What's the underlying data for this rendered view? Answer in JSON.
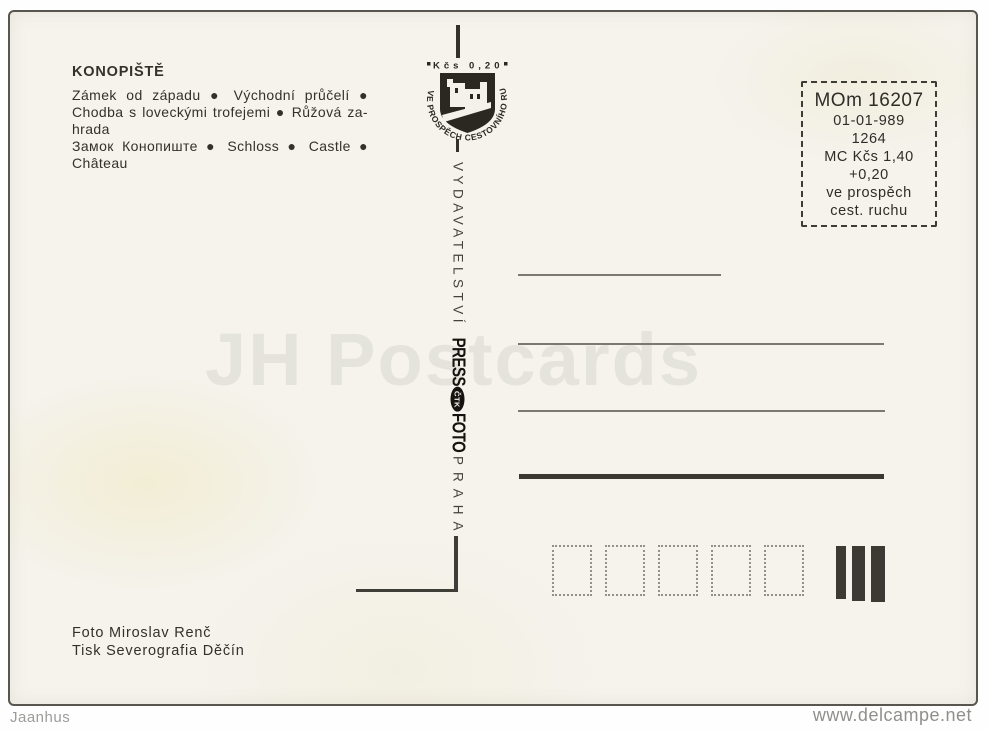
{
  "colors": {
    "ink": "#2e2b26",
    "paper": "#f5f3ec",
    "watermark": "#e4e3dc"
  },
  "overlay": {
    "watermark": "JH Postcards",
    "footer_left": "Jaanhus",
    "footer_right": "www.delcampe.net"
  },
  "postcard": {
    "title": "KONOPIŠTĚ",
    "description_lines": [
      "Zámek od západu ● Východní průčelí ●",
      "Chodba s loveckými trofejemi ● Růžová za-",
      "hrada",
      "Замок Конопиште ● Schloss ● Castle ●",
      "Château"
    ],
    "stamp": {
      "value_line": "Kčs 0,20",
      "ring_text": "VE PROSPĚCH CESTOVNÍHO RUCHU"
    },
    "spine": {
      "publisher": "VYDAVATELSTVÍ",
      "logo_press": "PRESS",
      "logo_ctk": "ČTK",
      "logo_foto": "FOTO",
      "city": "PRAHA"
    },
    "price_box": {
      "lines": [
        "MOm 16207",
        "01-01-989",
        "1264",
        "MC Kčs 1,40",
        "+0,20",
        "ve prospěch",
        "cest. ruchu"
      ]
    },
    "credits": [
      "Foto Miroslav Renč",
      "Tisk Severografia Děčín"
    ]
  }
}
